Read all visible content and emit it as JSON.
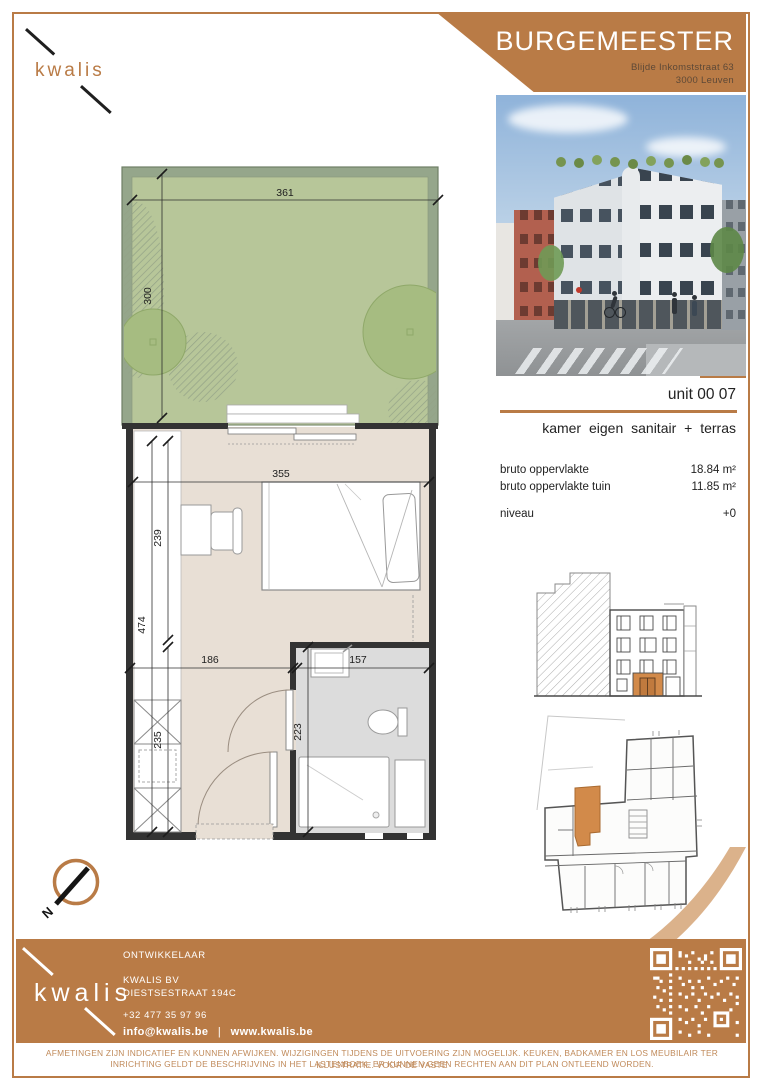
{
  "brand": {
    "logo_text": "kwalis"
  },
  "header": {
    "project_name": "BURGEMEESTER",
    "address_line1": "Blijde Inkomststraat 63",
    "address_line2": "3000 Leuven"
  },
  "unit": {
    "number": "unit 00 07",
    "description": "kamer eigen sanitair + terras",
    "specs": [
      {
        "label": "bruto oppervlakte",
        "value": "18.84 m²"
      },
      {
        "label": "bruto oppervlakte tuin",
        "value": "11.85 m²"
      }
    ],
    "level_label": "niveau",
    "level_value": "+0"
  },
  "floorplan": {
    "dimensions": {
      "terrace_width": "361",
      "terrace_depth": "300",
      "room_width": "355",
      "desk_zone_depth": "239",
      "room_depth": "474",
      "hall_width": "186",
      "bath_width": "157",
      "wardrobe_zone_depth": "235",
      "bath_depth": "223"
    },
    "north_label": "N"
  },
  "footer": {
    "developer_heading": "ONTWIKKELAAR",
    "company_name": "KWALIS BV",
    "company_street": "DIESTSESTRAAT 194C",
    "phone": "+32 477 35 97 96",
    "email": "info@kwalis.be",
    "separator": "|",
    "website": "www.kwalis.be",
    "logo_text": "kwalis"
  },
  "disclaimer": {
    "line1": "AFMETINGEN ZIJN INDICATIEF EN KUNNEN AFWIJKEN. WIJZIGINGEN TIJDENS DE UITVOERING ZIJN MOGELIJK. KEUKEN, BADKAMER EN LOS MEUBILAIR TER ILLUSTRATIE. VOOR DE VASTE",
    "line2": "INRICHTING GELDT DE BESCHRIJVING IN HET LASTENBOEK. ER KUNNEN GEEN RECHTEN AAN DIT PLAN ONTLEEND WORDEN."
  },
  "colors": {
    "accent": "#b97b46",
    "accent_light": "#d9ae85",
    "unit_highlight": "#d28a4a",
    "garden_green": "#b7c699",
    "hedge_green": "#95a68b",
    "floor_beige": "#e8dfd5",
    "bath_gray": "#dcdcdc"
  }
}
